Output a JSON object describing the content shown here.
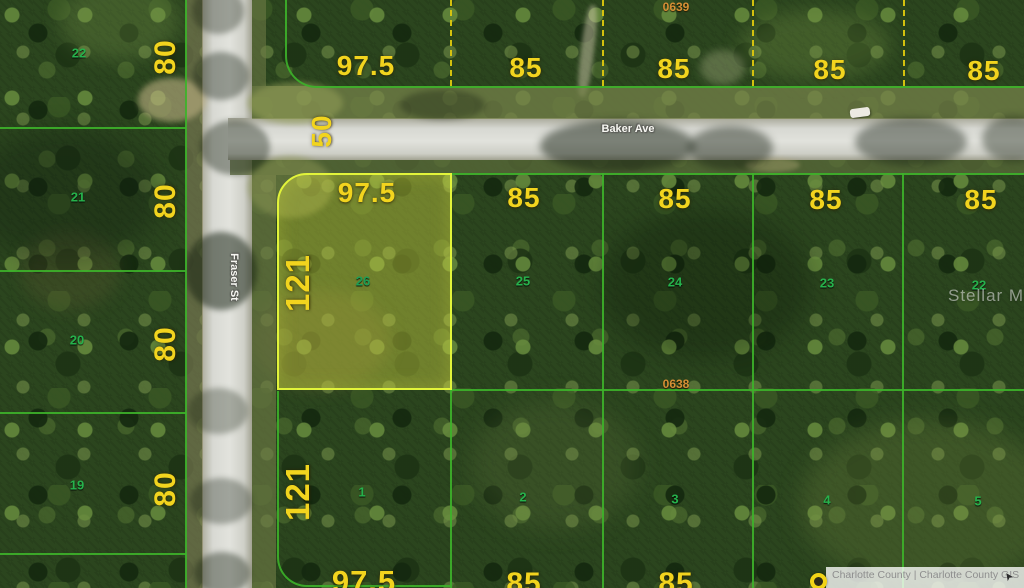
{
  "streets": {
    "baker": "Baker Ave",
    "fraser": "Fraser St",
    "right_of_way": "50"
  },
  "blocks": {
    "north": "0639",
    "south": "0638"
  },
  "top_row": {
    "dims": [
      "97.5",
      "85",
      "85",
      "85",
      "85"
    ]
  },
  "mid_row": {
    "dims": [
      "97.5",
      "85",
      "85",
      "85",
      "85"
    ],
    "lots": [
      "26",
      "25",
      "24",
      "23",
      "22"
    ]
  },
  "bottom_row": {
    "dims": [
      "97.5",
      "85",
      "85"
    ],
    "lots": [
      "1",
      "2",
      "3",
      "4",
      "5"
    ]
  },
  "left_col": {
    "dims": [
      "80",
      "80",
      "80",
      "80"
    ],
    "lots": [
      "22",
      "21",
      "20",
      "19"
    ]
  },
  "depths": {
    "lot26": "121",
    "lot1": "121"
  },
  "highlighted_lot": {
    "number": "26",
    "width": "97.5",
    "depth": "121"
  },
  "watermark": "Stellar MLS",
  "attribution": "Charlotte County | Charlotte County GIS",
  "icons": {
    "map_pin": "yellow-circle-pin",
    "cursor": "cursor-arrow"
  },
  "colors": {
    "dimension_text": "#f2d41e",
    "lot_number_text": "#26b24c",
    "boundary_line": "#3db22a",
    "dashed_separator": "#ddc80e",
    "highlight_border": "#e2f43a",
    "highlight_fill": "rgba(208,212,66,0.42)",
    "block_id_text": "#d68f35",
    "road": "#d7d8d2"
  }
}
